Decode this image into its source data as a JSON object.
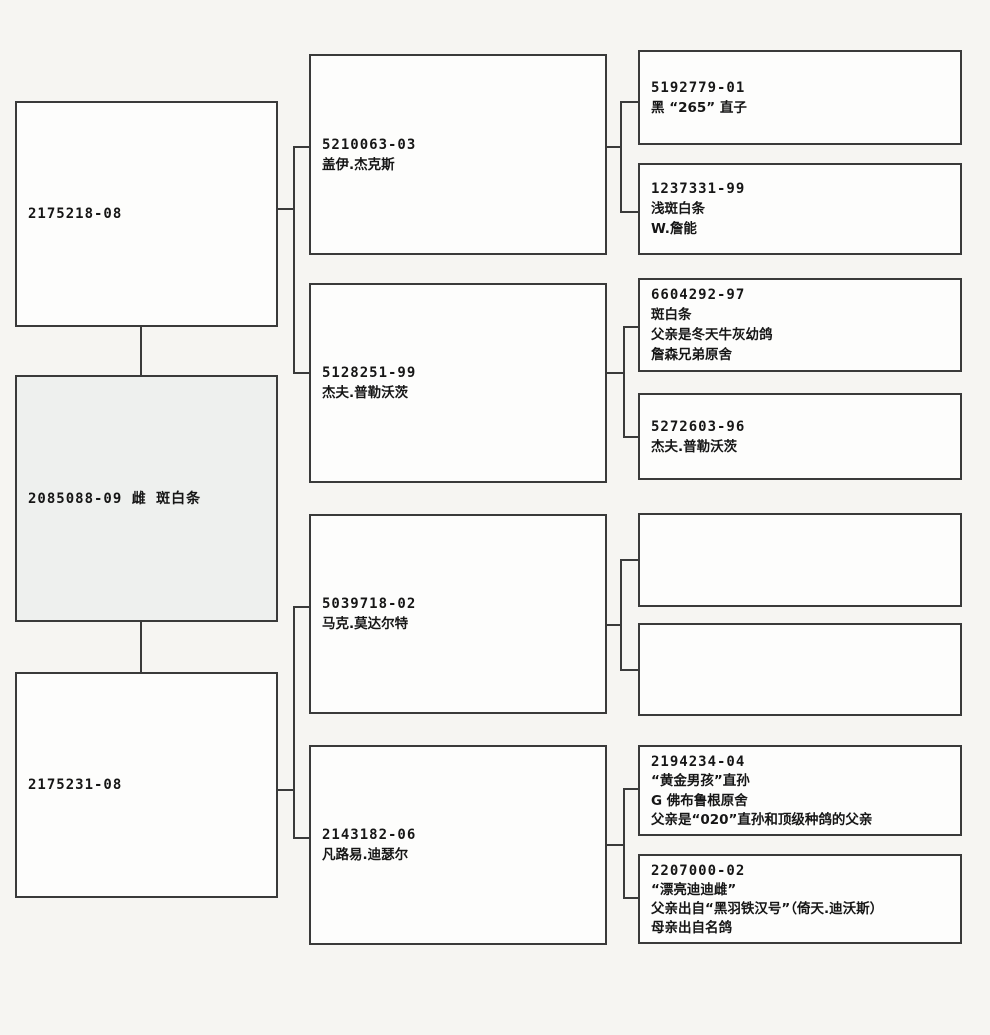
{
  "document_type": "pigeon-pedigree-chart",
  "colors": {
    "paper": "#f6f5f2",
    "box_fill": "#fdfdfc",
    "subject_box_fill": "#eef0ee",
    "line_color": "#3a3a3a",
    "ink": "#161616"
  },
  "pedigree": {
    "subject": {
      "lines": [
        "2085088-09 雌 斑白条"
      ]
    },
    "sire": {
      "lines": [
        "2175218-08"
      ]
    },
    "dam": {
      "lines": [
        "2175231-08"
      ]
    },
    "gen2": [
      {
        "lines": [
          "5210063-03",
          "盖伊.杰克斯"
        ]
      },
      {
        "lines": [
          "5128251-99",
          "杰夫.普勒沃茨"
        ]
      },
      {
        "lines": [
          "5039718-02",
          "马克.莫达尔特"
        ]
      },
      {
        "lines": [
          "2143182-06",
          "凡路易.迪瑟尔"
        ]
      }
    ],
    "gen3": [
      {
        "lines": [
          "5192779-01",
          "黑 “265” 直子"
        ]
      },
      {
        "lines": [
          "1237331-99",
          "浅斑白条",
          "W.詹能"
        ]
      },
      {
        "lines": [
          "6604292-97",
          "斑白条",
          "父亲是冬天牛灰幼鸽",
          "詹森兄弟原舍"
        ]
      },
      {
        "lines": [
          "5272603-96",
          "杰夫.普勒沃茨"
        ]
      },
      {
        "lines": []
      },
      {
        "lines": []
      },
      {
        "lines": [
          "2194234-04",
          "“黄金男孩”直孙",
          "G 佛布鲁根原舍",
          "父亲是“020”直孙和顶级种鸽的父亲"
        ]
      },
      {
        "lines": [
          "2207000-02",
          "“漂亮迪迪雌”",
          "父亲出自“黑羽铁汉号”（倚天.迪沃斯）",
          "母亲出自名鸽"
        ]
      }
    ]
  }
}
